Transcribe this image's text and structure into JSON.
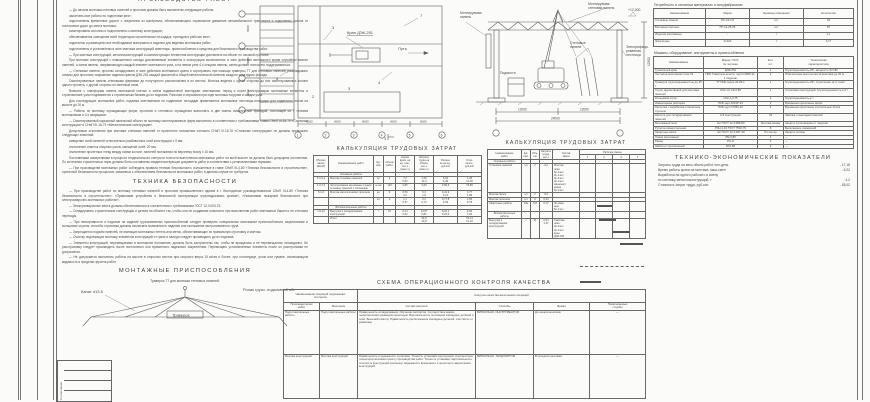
{
  "doc": {
    "top_heading": "ПРОИЗВОДСТВО РАБОТ",
    "paragraphs": [
      {
        "t": "— До начала монтажа стеновых панелей и прогонов должны быть выполнены следующие работы:"
      },
      {
        "t": "закончены все работы по подготовке мест;"
      },
      {
        "t": "подготовлены временные дороги с покрытием из материала, обеспечивающего нормальное движение автомобильного транспорта и подъемных кранов от постоянных дорог до места монтажа;"
      },
      {
        "t": "смонтированы колонны и подготовлены к монтажу конструкции;"
      },
      {
        "t": "обеспечивается освещение всей территории строительных площадок, проездов и рабочих мест;"
      },
      {
        "t": "поднесены и размещены все необходимые материалы и изделия для ведения монтажных работ;"
      },
      {
        "t": "подготовлены и установлены в зоне монтажа конструкций инвентарь, приспособления и средства для безопасного производства работ."
      },
      {
        "t": "— При монтаже конструкций, металлоконструкций и комплектующих элементов конструкции доставлять на объект по часовой прогонке."
      },
      {
        "t": "При монтаже конструкций с повышенного склада доставляемые элементы и конструкции исключаются; в зоне действия монтажного крана случайное взятие панелей, а затем панель, направляющую каждый элемент монтажного узла, а на левом узле 4-х секциях панель, затем должен постоянно поддерживаться."
      },
      {
        "t": "— Стеновые панели, прогоны складировать в зоне действия монтажного крана и сортировать при помощи траверсы Т7 для стеновых панелей; раскладывать отвалы для прогонов; покрывные изделия краном ДЭК-251 каждой фасонной и общей металлической панелью каждого хода вдоль фасада."
      },
      {
        "t": "Смонтированные панели стеновыми фермами до полуторного расположения в их местах. Монтаж ведется с одной стороны до них смонтированных колонн одного пролета, с другой стороны по сменным осям."
      },
      {
        "t": "Вначале с платформы панель монтажной клетью и затем подвешенной монтируют монтажники: перед и после электросварки монтажные элементы и строповочные узлы поднимаются к стропильным балкам до их подъема. Разгонки и опускания при ходе монтажа погрузки и осадки узла."
      },
      {
        "t": "Для последующих монтажных работ, подъема монтажников на подвесные площадки применяются монтажные лестницы-площадки для подвесных лесов на высоте до 20 м."
      },
      {
        "t": "— Работы по монтажу ограждающих ферм, прогонов и стенового ограждения выполнять в две смены комплексной бригадой, состоящей из 7 человек монтажников и 3-х сварщиков."
      },
      {
        "t": "— Смонтированный каркасный панельный объект по монтажу смонтированных ферм выполнять в соответствии с требованиями главы СНиП III-18-75 «Стальные конструкции» и СНиП III-16-73 «Металлические конструкции»."
      },
      {
        "t": "Допустимые отклонения при монтаже стеновых панелей от проектного положения согласно СНиП III-16-76 «Стальные конструкции» не должны превышать следующих значений:"
      },
      {
        "t": "смещение осей панелей относительно разбивочных осей конструкции ± 5 мм;"
      },
      {
        "t": "отклонение отметок опорных узлов, смещение осей: 20 мм;"
      },
      {
        "t": "отклонение пролетных гнезд между осями колонн, панелей положения по верхнему поясу ± 10 мм."
      },
      {
        "t": "Постоянными измерениями в процессе геодезического контроля точности выполнения монтажных работ на всей высоте не должны быть допущены отклонения. По истечении строительных норм должны быть составлены свидетельствующие документы работ в соответствии с установленными нормами."
      },
      {
        "t": "— При производстве монтажных работ соблюдать правила техники безопасности, изложенные в главе СНиП III-4-80 «Техника безопасности в строительстве», проектной безопасности процессов, связанных с обеспечением безопасности монтажных работ, в данном случае не требуется."
      }
    ],
    "safety_heading": "ТЕХНИКА БЕЗОПАСНОСТИ",
    "safety": [
      {
        "t": "— При производстве работ по монтажу стеновых панелей и прогонов промышленного здания в г. Волгодонске руководствоваться СНиП III-4-80 «Техника безопасности в строительстве», «Правилами устройства и безопасной эксплуатации грузоподъемных кранов», «Указаниями пожарной безопасности при электросварочно-монтажных работах»."
      },
      {
        "t": "— Электросварочные места должны обеспечиваться в соответствии с требованиями ГОСТ 12.3.003-75."
      },
      {
        "t": "— Складировать строительные конструкции и детали на объекте так, чтобы они не создавали опасности при выполнении работ монтажных башен и не стесняли переходы."
      },
      {
        "t": "— При неисправности и подъеме на изделие грузозахватных приспособлений следует проверить специальные монтажные приспособления, зацепляемые и кольцевые стропы; способы строповки должны исключать возможность падения или скольжения застропованного груза."
      },
      {
        "t": "— Запрещается подъем панелей, не имеющих монтажных петель или меток, обеспечивающих их правильную строповку и монтаж."
      },
      {
        "t": "— Очистку подлежащих монтажу элементов конструкций от грязи и наледи следует производить до их подъема."
      },
      {
        "t": "— Элементы конструкций, перемещаемые в монтажное положение, должны быть застроплены так, чтобы не вращались и не перемещались неожиданно. Их расстроповку следует производить после постоянного или временного надежного закрепления. Перемещать установленные элементы после их расстроповки не допускается."
      },
      {
        "t": "— Не допускается выполнять работы на высоте в открытых местах при скорости ветра 15 м/сек и более, при гололедице, грозе или тумане, исключающем видимость в пределах фронта работ."
      }
    ],
    "rigging_heading": "МОНТАЖНЫЕ ПРИСПОСОБЛЕНИЯ",
    "rigging_subtitle": "Траверса Т7 для монтажа стеновых панелей.",
    "rigging_labels": {
      "rope": "Канат d13,5",
      "roller": "Ролик грузо-\nподъемной\nобоймы",
      "traverse": "Траверса"
    }
  },
  "plan": {
    "crane_label": "Кран ДЭК-251",
    "path_label": "Путь",
    "dims_left": [
      "6000",
      "6000",
      "6000"
    ],
    "dims_bottom": [
      "6000",
      "6000",
      "6000",
      "6000",
      "6000"
    ],
    "axes_bottom": [
      "1",
      "2",
      "3",
      "4",
      "5",
      "6"
    ],
    "callouts": {
      "c2": "2",
      "c3": "3",
      "c4": "4",
      "c5": "5",
      "c7": "7",
      "c3b": "3"
    },
    "section_mark": "1"
  },
  "elevation": {
    "labels": {
      "mounted_left": "Монтируемая\nпанель",
      "mounted_top": "Монтируемая\nстеновая панель",
      "ladder": "Электрифици-\nрованная\nлестница",
      "panels": "Стеновые\nпанели",
      "scaffold": "Подмости",
      "level_mark": "+12,000",
      "dim_right": "12300"
    },
    "dims": [
      "12000",
      "12000"
    ],
    "dim_total": "24000"
  },
  "calc1": {
    "title": "КАЛЬКУЛЯЦИЯ ТРУДОВЫХ ЗАТРАТ",
    "headers": [
      "Обосно-\nвание\n(ЕНиР)",
      "Наименование работ",
      "Ед.\nизм.",
      "Объем\nработ",
      "Норма\nврем. на\nед. изм.,\nчел-ч\n(маш-ч)",
      "Затраты\nтруда на\nобъем,\nчел-ч\n(маш-ч)",
      "Расцен-\nка на ед.,\nруб-коп",
      "Стои-\nмость,\nруб-коп"
    ],
    "rows": [
      {
        "base": "",
        "name": "Основные работы",
        "unit": "",
        "vol": "",
        "norm": "",
        "lab": "",
        "rate": "",
        "cost": "",
        "sec": "1"
      },
      {
        "base": "5-1-6,а",
        "name": "Монтаж стеновых панелей",
        "unit": "шт",
        "vol": "2",
        "norm": "7,2\n0,52",
        "lab": "1,26\n10,4",
        "rate": "5-64\n0-39",
        "cost": "1-28\n11-18"
      },
      {
        "base": "4-0-7,2",
        "name": "Электросварка монтажных стыков стеновых панелей с колоннами",
        "unit": "м шв",
        "vol": "129",
        "norm": "0,85",
        "lab": "0,69",
        "rate": "0-59,6",
        "cost": "76-89"
      },
      {
        "base": "5-1-6",
        "name": "Монтаж металлических прогонов",
        "unit": "шт",
        "vol": "9",
        "norm": "0,59\n0,2",
        "lab": "5,3\n1,8",
        "rate": "0-41,9\n0-21",
        "cost": "3-77\n1-89"
      },
      {
        "base": "",
        "name": "",
        "unit": "шт",
        "vol": "2",
        "norm": "1,1\n0,37",
        "lab": "2,2\n0,74",
        "rate": "0-77,8\n0-39",
        "cost": "1-56\n0-78"
      },
      {
        "base": "",
        "name": "Вспомогательные работы",
        "unit": "",
        "vol": "",
        "norm": "",
        "lab": "",
        "rate": "",
        "cost": "",
        "sec": "1"
      },
      {
        "base": "1-5-12",
        "name": "Выгрузка и складирование конструкций",
        "unit": "т",
        "vol": "31",
        "norm": "0,44\n0,22",
        "lab": "13,67\n6,82",
        "rate": "0-31,1\n0-23,4",
        "cost": "9-64\n7-25"
      },
      {
        "base": "",
        "name": "Итого",
        "unit": "",
        "vol": "",
        "norm": "",
        "lab": "33,8\n19,8",
        "rate": "",
        "cost": "93-14\n21-10"
      }
    ]
  },
  "schedule": {
    "title": "КАЛЬКУЛЯЦИЯ ТРУДОВЫХ ЗАТРАТ",
    "headers": [
      "Наименование\nработ",
      "Ед.\nизм.",
      "Объ-\nем",
      "Затраты\nтруда,\nчел-ч",
      "Состав\nзвена"
    ],
    "shifts_header": "Рабочие смены",
    "shift_cols": [
      "1",
      "2",
      "3",
      "4"
    ],
    "rows": [
      {
        "name": "Основные работы",
        "unit": "",
        "vol": "",
        "lab": "",
        "crew": "",
        "sec": "1"
      },
      {
        "name": "Установка панелей",
        "unit": "шт",
        "vol": "2",
        "lab": "4,2",
        "crew": "Монтаж-\nники:\n5р-1чел\n4р-1чел\n3р-2чел\n2р-1чел\nмашинист\nкрана\n6р-1чел"
      },
      {
        "name": "Монтаж балок",
        "unit": "шт",
        "vol": "2",
        "lab": "0,9",
        "crew": ""
      },
      {
        "name": "Монтаж прогонов",
        "unit": "шт",
        "vol": "9",
        "lab": "0,34",
        "crew": ""
      },
      {
        "name": "Сварочные работы",
        "unit": "10м",
        "vol": "6,8",
        "lab": "0,17",
        "crew": "Эл.свар-\nщик\n5р-1чел"
      },
      {
        "name": "Вспомогательные работы",
        "unit": "",
        "vol": "",
        "lab": "",
        "crew": "",
        "sec": "1"
      },
      {
        "name": "Выгрузка и складирование конструкций",
        "unit": "т",
        "vol": "31",
        "lab": "0,64\n1,37",
        "crew": "Такелаж-\nники\n2р-2чел\n4р-1чел\nкран\nДЭК-251"
      }
    ],
    "bars": [
      {
        "x0": 0.27,
        "x1": 0.5,
        "y": 36,
        "dashed": false
      },
      {
        "x0": 0.3,
        "x1": 0.56,
        "y": 50,
        "dashed": false
      },
      {
        "x0": 0.5,
        "x1": 0.78,
        "y": 62,
        "dashed": false
      },
      {
        "x0": 0.62,
        "x1": 0.97,
        "y": 74,
        "dashed": false
      },
      {
        "x0": 0.02,
        "x1": 0.98,
        "y": 97,
        "dashed": true
      },
      {
        "x0": 0.02,
        "x1": 0.33,
        "y": 112,
        "dashed": false
      }
    ]
  },
  "qc": {
    "title": "СХЕМА ОПЕРАЦИОННОГО КОНТРОЛЯ КАЧЕСТВА",
    "head_left": "Наименование операций подлежащих\nконтролю",
    "head_right": "Контроль качества выполнения операций",
    "sub_headers": [
      "Производителем\nработ",
      "Мастером",
      "Состав контроля",
      "Способы",
      "Время",
      "Привлекаемые\nслужбы"
    ],
    "rows": [
      {
        "prod": "Подготовительные работы",
        "master": "Подготовительные работы",
        "content": "Правильность складирования. Изучение паспортов. Соответствие марки, геометрических размеров проектным. Вертикальность положения закладных деталей и осей. Внешний осмотр. Правильность расположения закладных деталей, очистка их от ржавчины",
        "method": "ВИЗУАЛЬНО, ИНСТРУМЕНТОМ",
        "time": "До начала монтажа",
        "services": "—"
      },
      {
        "prod": "Монтаж конструкций",
        "master": "Монтаж конструкций",
        "content": "Правильность и надежность строповки. Точность установки конструкций. Соответствие технологии монтажа проекту производства работ. Точность установки: вертикальность, соосность конструкций (колонны). Надежность временного и проектного закрепления конструкций",
        "method": "ВИЗУАЛЬНО, ТЕОДОЛИТОМ",
        "time": "В процессе монтажа",
        "services": "—"
      }
    ]
  },
  "resources": {
    "page_title": "МАТЕРИАЛЬНО-ТЕХНИЧЕСКИЕ РЕСУРСЫ",
    "materials_caption": "Потребность в основных материалах и полуфабрикатах",
    "materials_headers": [
      "Наименование",
      "Марка",
      "Единица измерения",
      "Количество"
    ],
    "materials_rows": [
      {
        "name": "Стеновые панели",
        "mark": "ПС-24-2,5",
        "unit": "шт.",
        "qty": "34"
      },
      {
        "name": "Бетонные прогоны",
        "mark": "ПГ-12-25-65",
        "unit": "шт.",
        "qty": "87"
      },
      {
        "name": "Изделия монтажные",
        "mark": "-",
        "unit": "т",
        "qty": "1,1"
      },
      {
        "name": "Электроды",
        "mark": "Э-42А",
        "unit": "т",
        "qty": "0,17"
      }
    ],
    "machines_caption": "Машины, оборудование, инструменты и приспособления",
    "machines_headers": [
      "Наименование",
      "Марка, ГОСТ,\n№ чертежа",
      "Кол.\nшт.",
      "Техническая\nхарактеристика"
    ],
    "machines_rows": [
      {
        "name": "Гусеничный кран",
        "mark": "ДЭК-251",
        "qty": "1",
        "char": "Грузоподъемность-25т, мощность-52 кВт"
      },
      {
        "name": "Лестница монтажная типа Л1",
        "mark": "ПКБ Главсталь-констр. черт.С2908-11-1 изделие",
        "qty": "2",
        "char": "Обеспечение высоты места монтажа до 20 м"
      },
      {
        "name": "Траверса грузоподъемностью до 25 т",
        "mark": "Т7 ПКБ серия 44-05-1",
        "qty": "1",
        "char": "Грузоподъемность-25т, стропление за 4 точки"
      },
      {
        "name": "Строп двухветвевой для монтажа панелей",
        "mark": "2СК-1,6 СК-0,85",
        "qty": "1",
        "char": "Строповка конструкций. Грузоподъемность-1,6 т"
      },
      {
        "name": "Кольцевой строп",
        "mark": "СКК-1-0,75",
        "qty": "1",
        "char": "Грузоподъемность-2 т"
      },
      {
        "name": "Инвентарная распорка",
        "mark": "ПКБ черт.4034Р-44",
        "qty": "2",
        "char": "Временное крепление ферм"
      },
      {
        "name": "Расчалка с карабином и канатным стропом",
        "mark": "ПКБ черт.С7984-10",
        "qty": "4",
        "char": "Временное крепление стропильных балок"
      },
      {
        "name": "Кассета для складирования панелей",
        "mark": "К-8 конструкции",
        "qty": "34",
        "char": "Завозка и выкладка панелей"
      },
      {
        "name": "Монтажный пояс",
        "mark": "тип ГОСТ 12.4.089-80",
        "qty": "Монтаж-никам",
        "char": "Защита строповщика от падения"
      },
      {
        "name": "Рулетка измерительная",
        "mark": "РЗЦ 4-34 ГОСТ 7502-79",
        "qty": "8",
        "char": "Выполнение измерений"
      },
      {
        "name": "Защитные каски",
        "mark": "тип ГОСТ 12.4.087-49",
        "qty": "По кол-ву",
        "char": "Защита головы"
      },
      {
        "name": "Ломик монтажный",
        "mark": "ЛМ-0,85",
        "qty": "4",
        "char": "—"
      },
      {
        "name": "Ранец",
        "mark": "РС-Н",
        "qty": "2",
        "char": "—"
      },
      {
        "name": "Шаблон строительный",
        "mark": "9ХХ-80",
        "qty": "2",
        "char": "—"
      }
    ],
    "tep_title": "ТЕХНИКО-ЭКОНОМИЧЕСКИЕ ПОКАЗАТЕЛИ",
    "tep_lines": [
      {
        "label": "Затраты труда на весь объем работ, чел-день",
        "value": "- 17,18"
      },
      {
        "label": "Время работы крана на монтаже, маш-смен",
        "value": "- 6,22"
      },
      {
        "label": "Выработка на одного рабочего в смену",
        "value": ""
      },
      {
        "label": "по монтажу металлоконструкций, т",
        "value": "- 4,2"
      },
      {
        "label": "Стоимость затрат труда, руб-коп.",
        "value": "- 55,02"
      }
    ]
  },
  "stamp": {
    "side_label": "Согласовано"
  }
}
